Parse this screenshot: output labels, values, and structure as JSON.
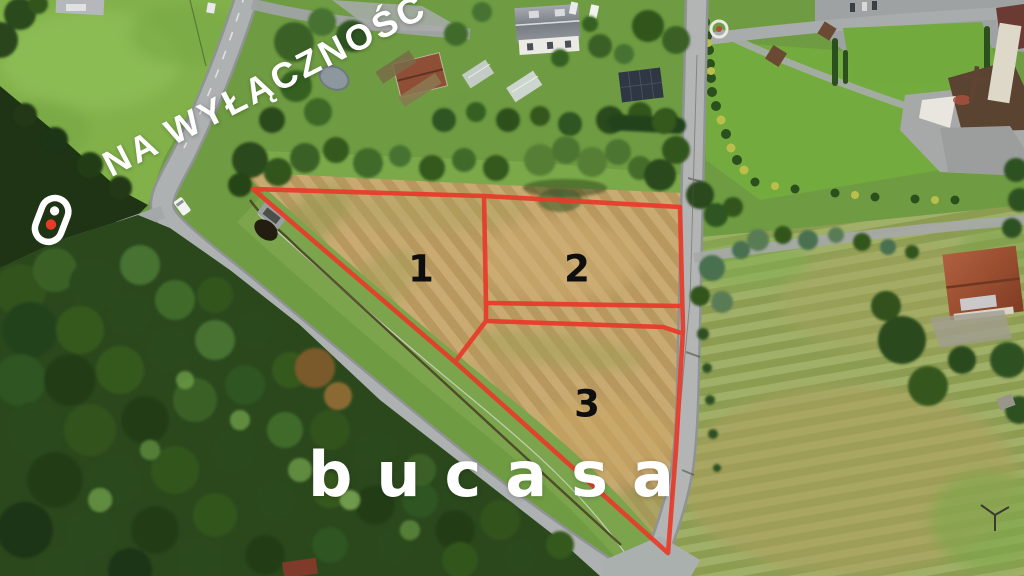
{
  "watermark": {
    "label": "NA WYŁĄCZNOŚĆ"
  },
  "brand": {
    "wordmark": "bucasa",
    "mark_icon": "brand-toggle-pin-icon",
    "accent_color": "#e73b2a",
    "text_color": "#ffffff"
  },
  "plots": {
    "labels": [
      "1",
      "2",
      "3"
    ],
    "outline_color": "#e73b2a",
    "number_color": "#0e0e0e"
  }
}
